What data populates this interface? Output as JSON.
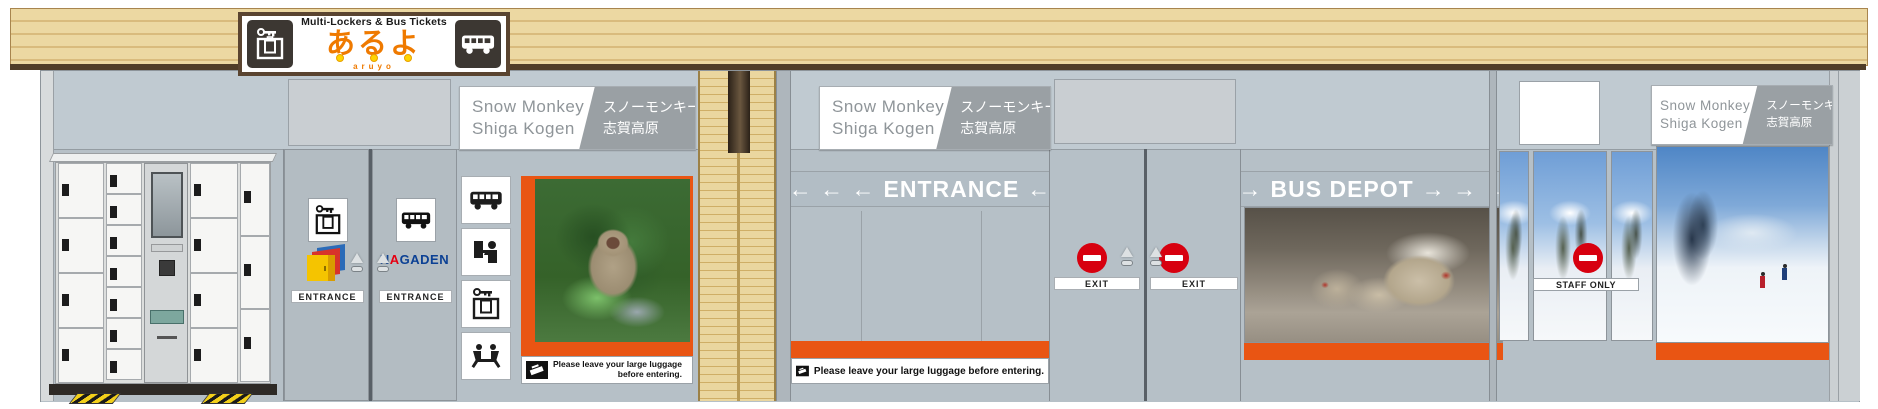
{
  "header_sign": {
    "subtitle": "Multi-Lockers & Bus Tickets",
    "title": "あるよ",
    "romaji": "aruyo"
  },
  "snow_monkey_sign": {
    "en1": "Snow Monkey",
    "en2": "Shiga Kogen",
    "jp1": "スノーモンキー",
    "jp2": "志賀高原"
  },
  "left_doors": {
    "locker_entrance_label": "ENTRANCE",
    "bus_entrance_label": "ENTRANCE",
    "nagaden": {
      "n": "N",
      "a": "A",
      "rest": "GADEN"
    }
  },
  "wayfinding": {
    "entrance_arrows_before": "← ← ←",
    "entrance_text": "ENTRANCE",
    "entrance_arrow_after": "←",
    "depot_arrow_before": "→",
    "depot_text": "BUS DEPOT",
    "depot_arrows_after": "→ → →"
  },
  "exit_doors": {
    "exit_label_left": "EXIT",
    "exit_label_right": "EXIT"
  },
  "staff_door": {
    "label": "STAFF ONLY"
  },
  "notices": {
    "luggage_line1": "Please leave your large luggage",
    "luggage_line2": "before entering.",
    "luggage_single": "Please leave your large luggage before entering."
  },
  "icons": {
    "header_left": "key-suitcase-locker-icon",
    "header_right": "bus-icon",
    "column": [
      "bus-icon",
      "ticket-counter-icon",
      "key-suitcase-locker-icon",
      "waiting-area-icon"
    ],
    "door_signs": [
      "key-suitcase-locker-icon",
      "bus-icon"
    ],
    "restriction": "no-entry-icon",
    "notice": "luggage-drop-icon"
  },
  "colors": {
    "accent_orange": "#e95513",
    "beam_tan": "#e9d3a1",
    "no_entry_red": "#d7000f",
    "nagaden_blue": "#0b4094",
    "nagaden_red": "#e60012",
    "sign_gray": "#9aa0a4"
  }
}
